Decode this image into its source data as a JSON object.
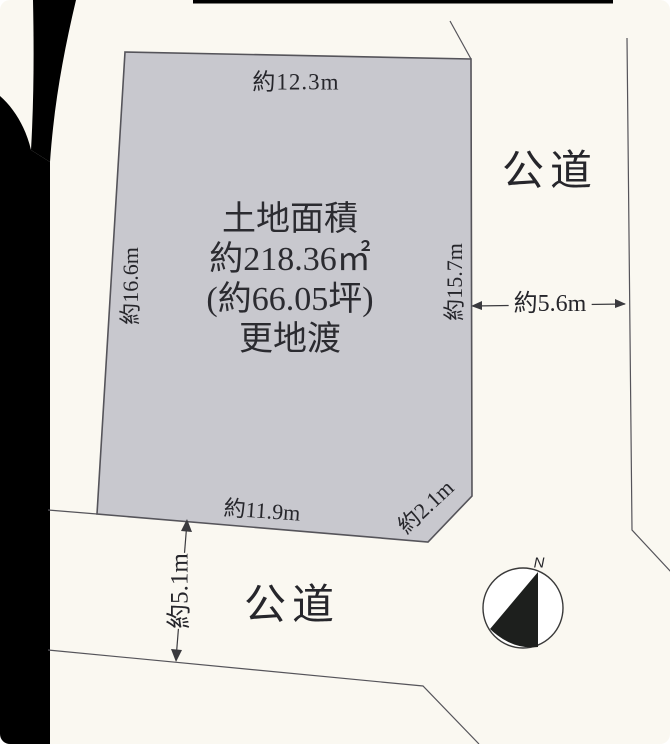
{
  "parcel": {
    "fill": "#c8c8ce",
    "area_lines": [
      "土地面積",
      "約218.36㎡",
      "(約66.05坪)",
      "更地渡"
    ],
    "dimensions": {
      "top": "約12.3m",
      "left": "約16.6m",
      "right": "約15.7m",
      "bottom": "約11.9m",
      "corner_cut": "約2.1m"
    }
  },
  "roads": {
    "right": {
      "label": "公道",
      "width": "約5.6m"
    },
    "bottom": {
      "label": "公道",
      "width": "約5.1m"
    }
  },
  "compass": {
    "north_label": "N"
  },
  "colors": {
    "background": "#faf8f1",
    "line": "#55545a",
    "text": "#26262b",
    "scan_artifact": "#000000"
  }
}
